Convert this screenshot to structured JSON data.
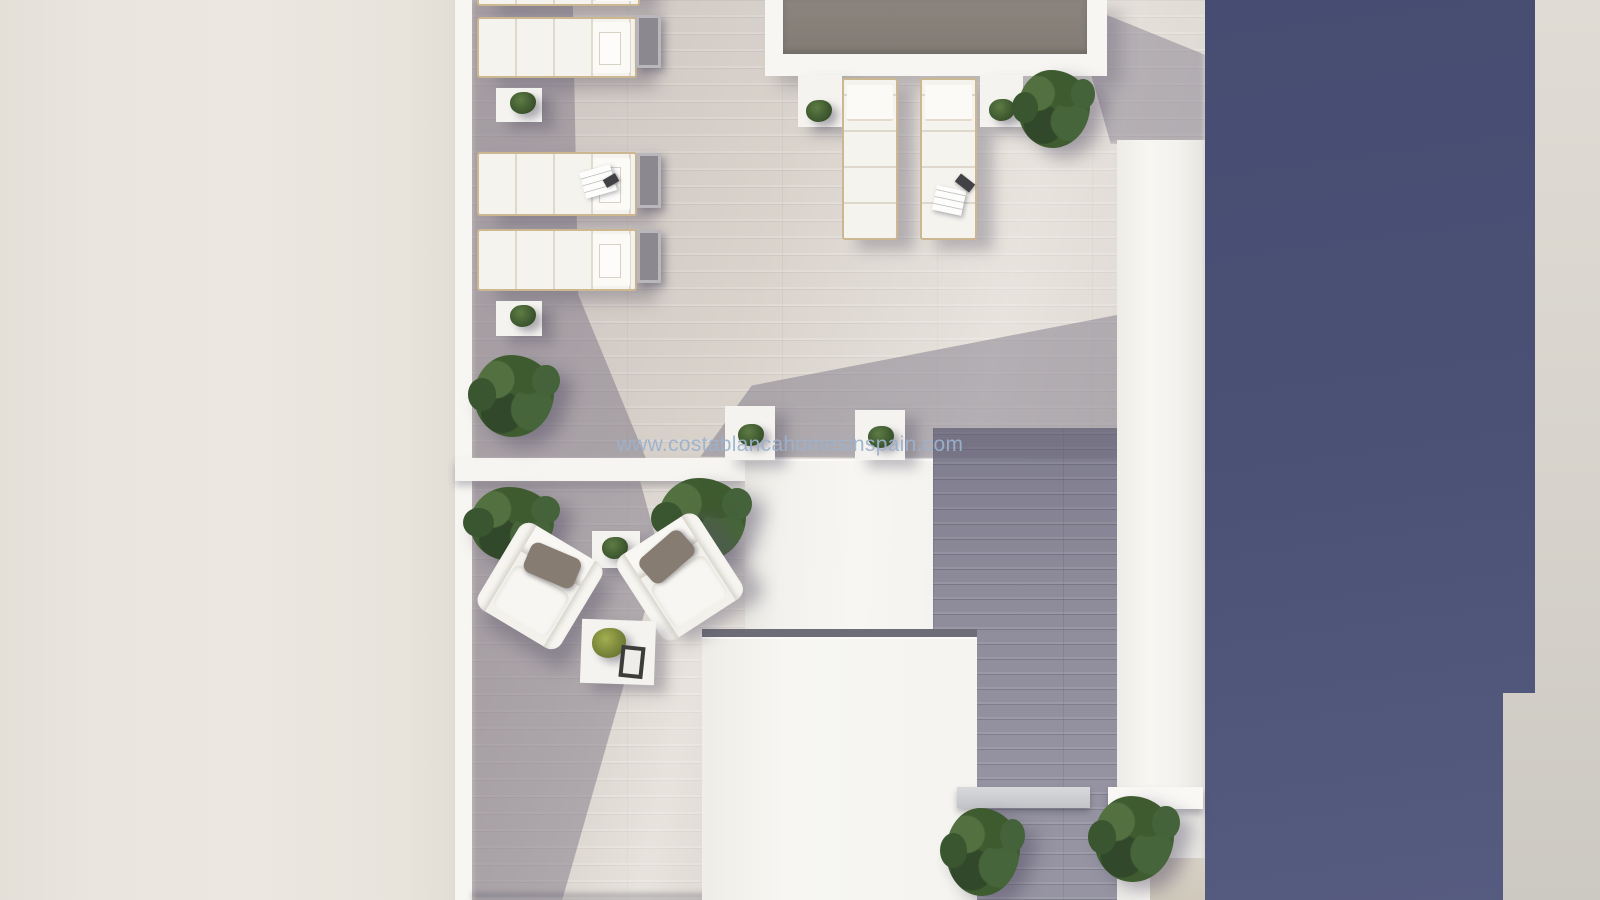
{
  "watermark": {
    "text": "www.costablancahomesinspain.com"
  },
  "palette": {
    "left_wall_beige": "#e9e5de",
    "white_structures": "#f6f5f1",
    "terrace_floor_light": "#d9d3cc",
    "deck_shadow_gray": "#8e8c9b",
    "pool_water_gray": "#87817a",
    "navy_building": "#4b5174",
    "right_margin_gray": "#d8d4cd",
    "foliage_green": "#3f5c31",
    "lounger_frame_tan": "#cdb791",
    "cushion_taupe": "#867c71",
    "watermark_blue": "#9cb2ce"
  },
  "objects": {
    "pool": 1,
    "sun_loungers_left_row": 4,
    "sun_loungers_poolside": 2,
    "armchairs": 2,
    "side_tables": 5,
    "coffee_tables": 1,
    "bushes": 6,
    "potted_plants": 6
  }
}
